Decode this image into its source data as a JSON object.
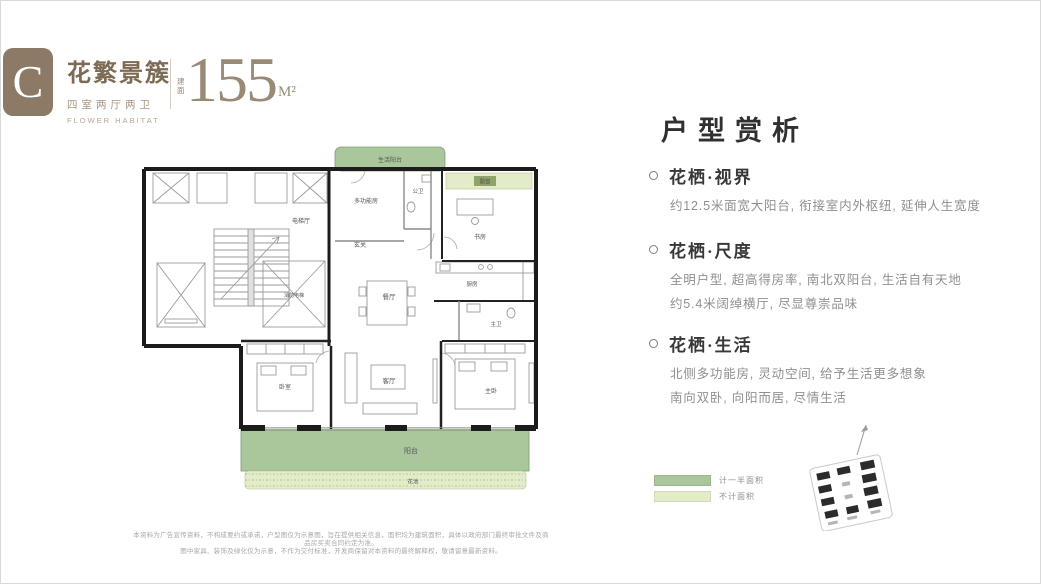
{
  "header": {
    "badge": "C",
    "title": "花繁景簇",
    "subtitle": "四室两厅两卫",
    "subtitle_en": "FLOWER HABITAT",
    "area_prefix": "建面",
    "area_value": "155",
    "area_unit": "M²"
  },
  "floorplan": {
    "rooms": {
      "life_balcony": "生活阳台",
      "bay_window": "飘窗",
      "multi_function": "多功能房",
      "public_bath": "公卫",
      "foyer": "玄关",
      "elevator_hall": "电梯厅",
      "fire_elevator": "消防电梯",
      "study": "书房",
      "kitchen": "厨房",
      "dining": "餐厅",
      "living": "客厅",
      "bedroom": "卧室",
      "master_bedroom": "主卧",
      "master_bath": "主卫",
      "balcony": "阳台",
      "flower_bed": "花池"
    }
  },
  "analysis": {
    "heading": "户型赏析",
    "sections": [
      {
        "title": "花栖·视界",
        "lines": [
          "约12.5米面宽大阳台, 衔接室内外枢纽, 延伸人生宽度"
        ]
      },
      {
        "title": "花栖·尺度",
        "lines": [
          "全明户型, 超高得房率, 南北双阳台, 生活自有天地",
          "约5.4米阔绰横厅, 尽显尊崇品味"
        ]
      },
      {
        "title": "花栖·生活",
        "lines": [
          "北侧多功能房, 灵动空间, 给予生活更多想象",
          "南向双卧, 向阳而居, 尽情生活"
        ]
      }
    ]
  },
  "legend": {
    "items": [
      {
        "label": "计一半面积",
        "color": "#a9c79b"
      },
      {
        "label": "不计面积",
        "color": "#e3ecc8"
      }
    ]
  },
  "colors": {
    "brand_brown": "#8d7a66",
    "balcony_green": "#a9c79b",
    "light_green": "#e3ecc8",
    "wall_black": "#1c1c1c"
  },
  "disclaimer": {
    "line1": "本资料为广告宣传资料，不构成要约或承诺，户型图仅为示意图，旨在提供相关信息，面积均为建筑面积，具体以政府部门最终审批文件及商品房买卖合同约定为准。",
    "line2": "图中家具、装饰及绿化仅为示意，不作为交付标准，开发商保留对本资料的最终解释权，敬请留意最新资料。"
  }
}
